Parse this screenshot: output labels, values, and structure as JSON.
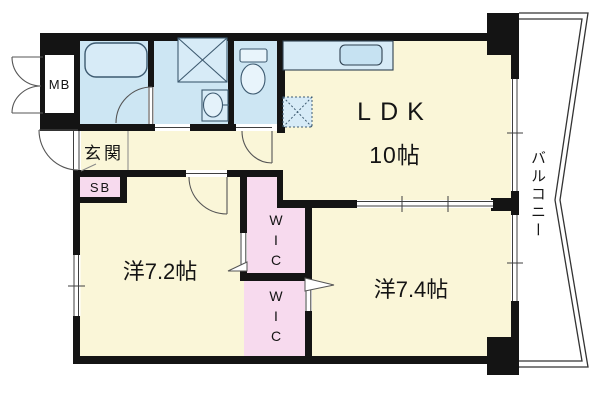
{
  "title": "マンション間取り図 (2LDK floor plan)",
  "labels": {
    "mb": "MB",
    "genkan": "玄関",
    "sb": "SB",
    "ldk": "LDK",
    "ldk_size": "10帖",
    "western_72": "洋7.2帖",
    "western_74": "洋7.4帖",
    "wic_upper": "WIC",
    "wic_lower": "WIC",
    "balcony": "バルコニー"
  },
  "colors": {
    "wall": "#141414",
    "room-cream": "#faf6d8",
    "wet-blue": "#cde6f3",
    "storage-pink": "#f7daee",
    "fixture-fill": "#d7ebf7",
    "fixture-line": "#3d5a70",
    "thin-line": "#3f3f3f"
  }
}
